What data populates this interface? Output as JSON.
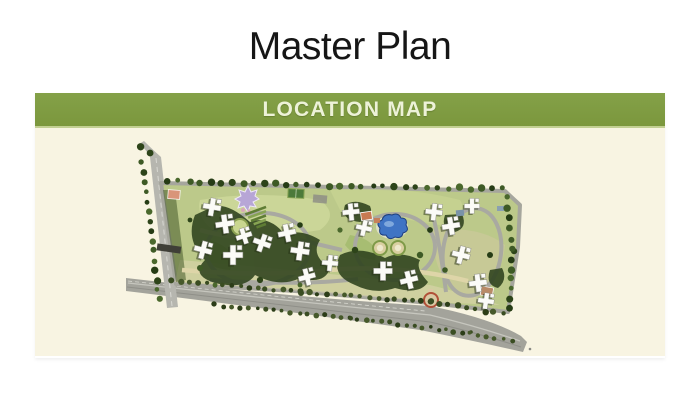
{
  "page": {
    "title": "Master Plan",
    "background_color": "#ffffff"
  },
  "panel": {
    "header": {
      "label": "LOCATION MAP",
      "background_color": "#7e9a41",
      "text_color": "#edf2d8"
    },
    "body_background_color": "#f8f4e2",
    "map": {
      "type": "aerial-site-plan-illustration",
      "features": [
        "highway-road",
        "access-road",
        "boundary-tree-rows",
        "residential-tower-clusters",
        "central-swimming-pool",
        "ornamental-star-pool",
        "terraced-garden",
        "sports-court",
        "clubhouse-buildings",
        "circular-lawns",
        "landscaped-gardens"
      ],
      "palette": {
        "site_green": "#bcc98a",
        "dark_foliage": "#2e421d",
        "road_gray": "#a3a39b",
        "building_white": "#fbfbf7",
        "pool_blue": "#3f74c4",
        "ornamental_purple": "#b7a6d6",
        "accent_salmon": "#c87a52",
        "path_tan": "#ded5a8"
      }
    }
  }
}
